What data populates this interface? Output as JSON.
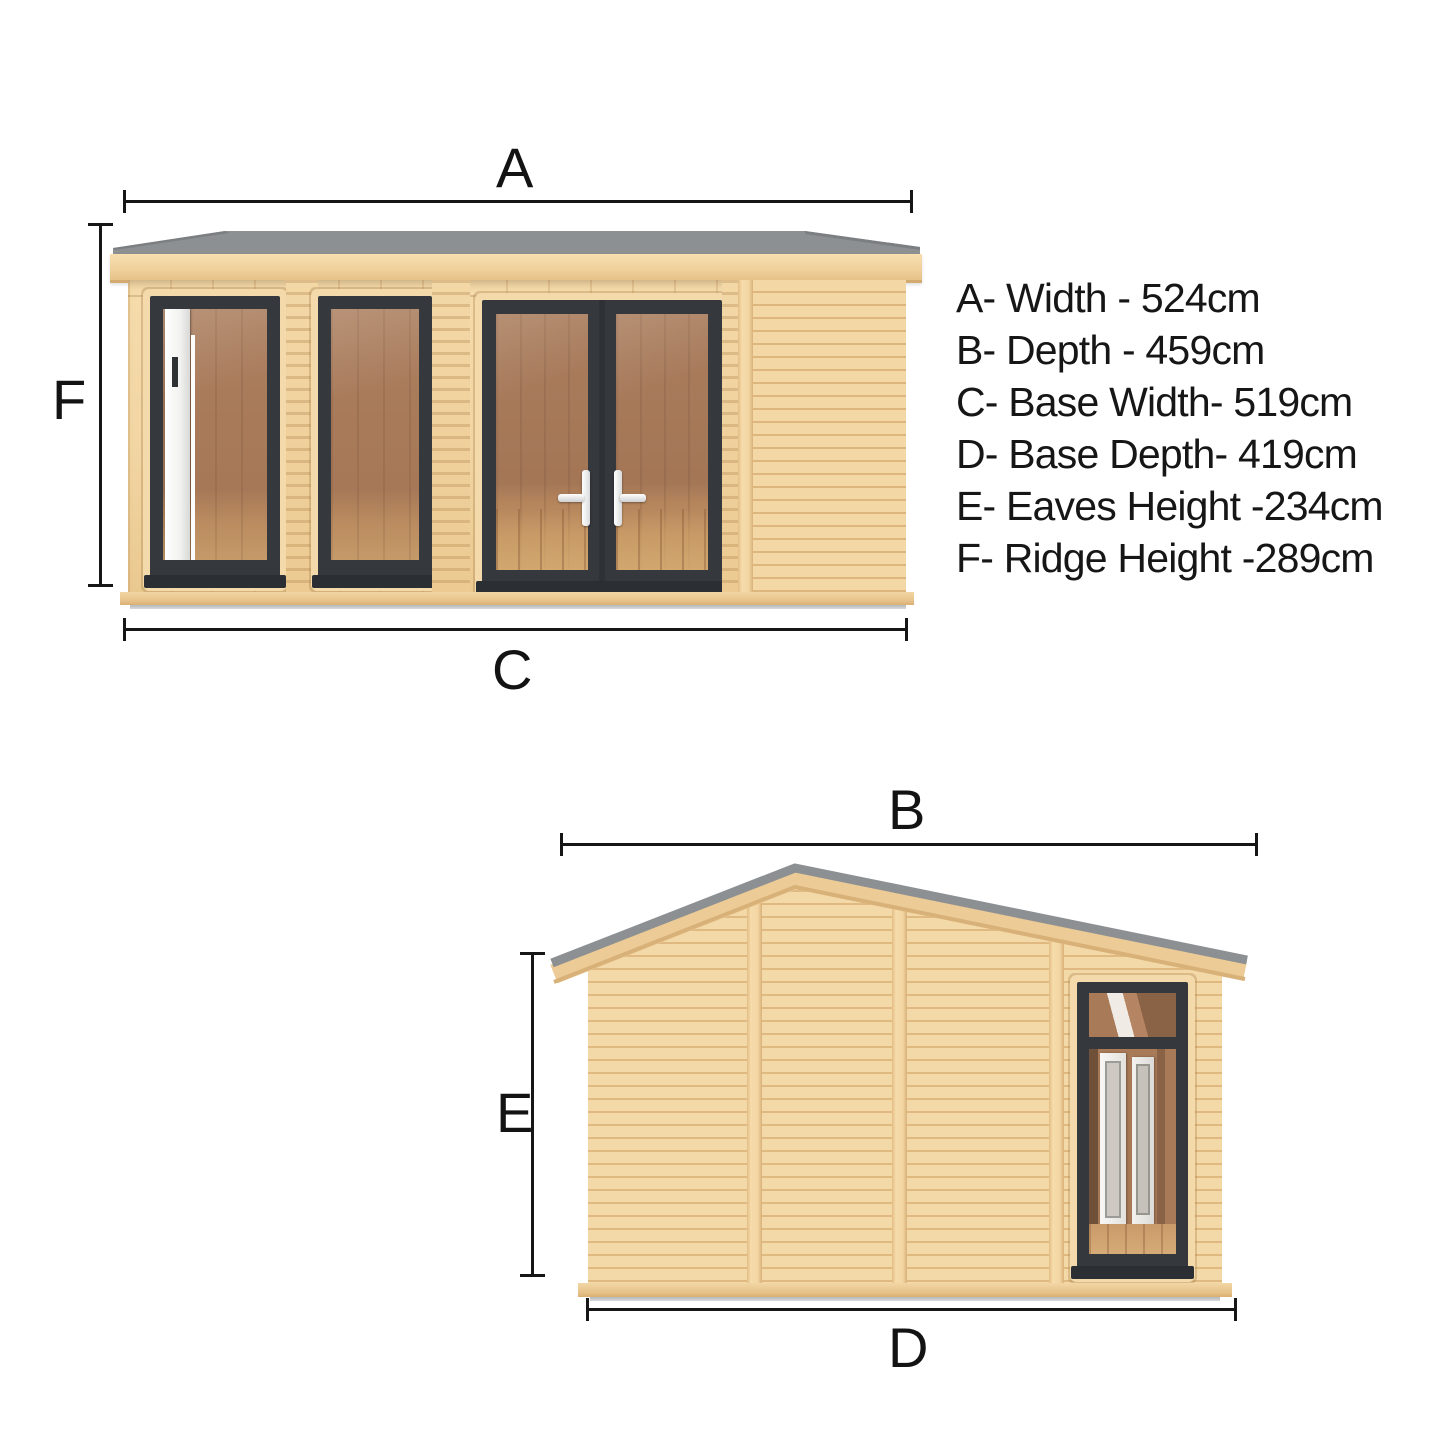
{
  "front_view": {
    "top_label": "A",
    "side_label": "F",
    "bottom_label": "C"
  },
  "side_view": {
    "top_label": "B",
    "side_label": "E",
    "bottom_label": "D"
  },
  "legend": {
    "items": [
      "A- Width - 524cm",
      "B- Depth - 459cm",
      "C- Base Width- 519cm",
      "D- Base Depth- 419cm",
      "E- Eaves Height -234cm",
      "F- Ridge Height -289cm"
    ]
  },
  "colors": {
    "wood_light": "#f2d7a6",
    "wood_dark": "#ddb67e",
    "roof_gray": "#8d9093",
    "frame_charcoal": "#35383d",
    "interior_brown": "#a87c5c",
    "floor_tan": "#c49468",
    "white_door": "#f5f4f2",
    "dimension_line": "#161616"
  }
}
